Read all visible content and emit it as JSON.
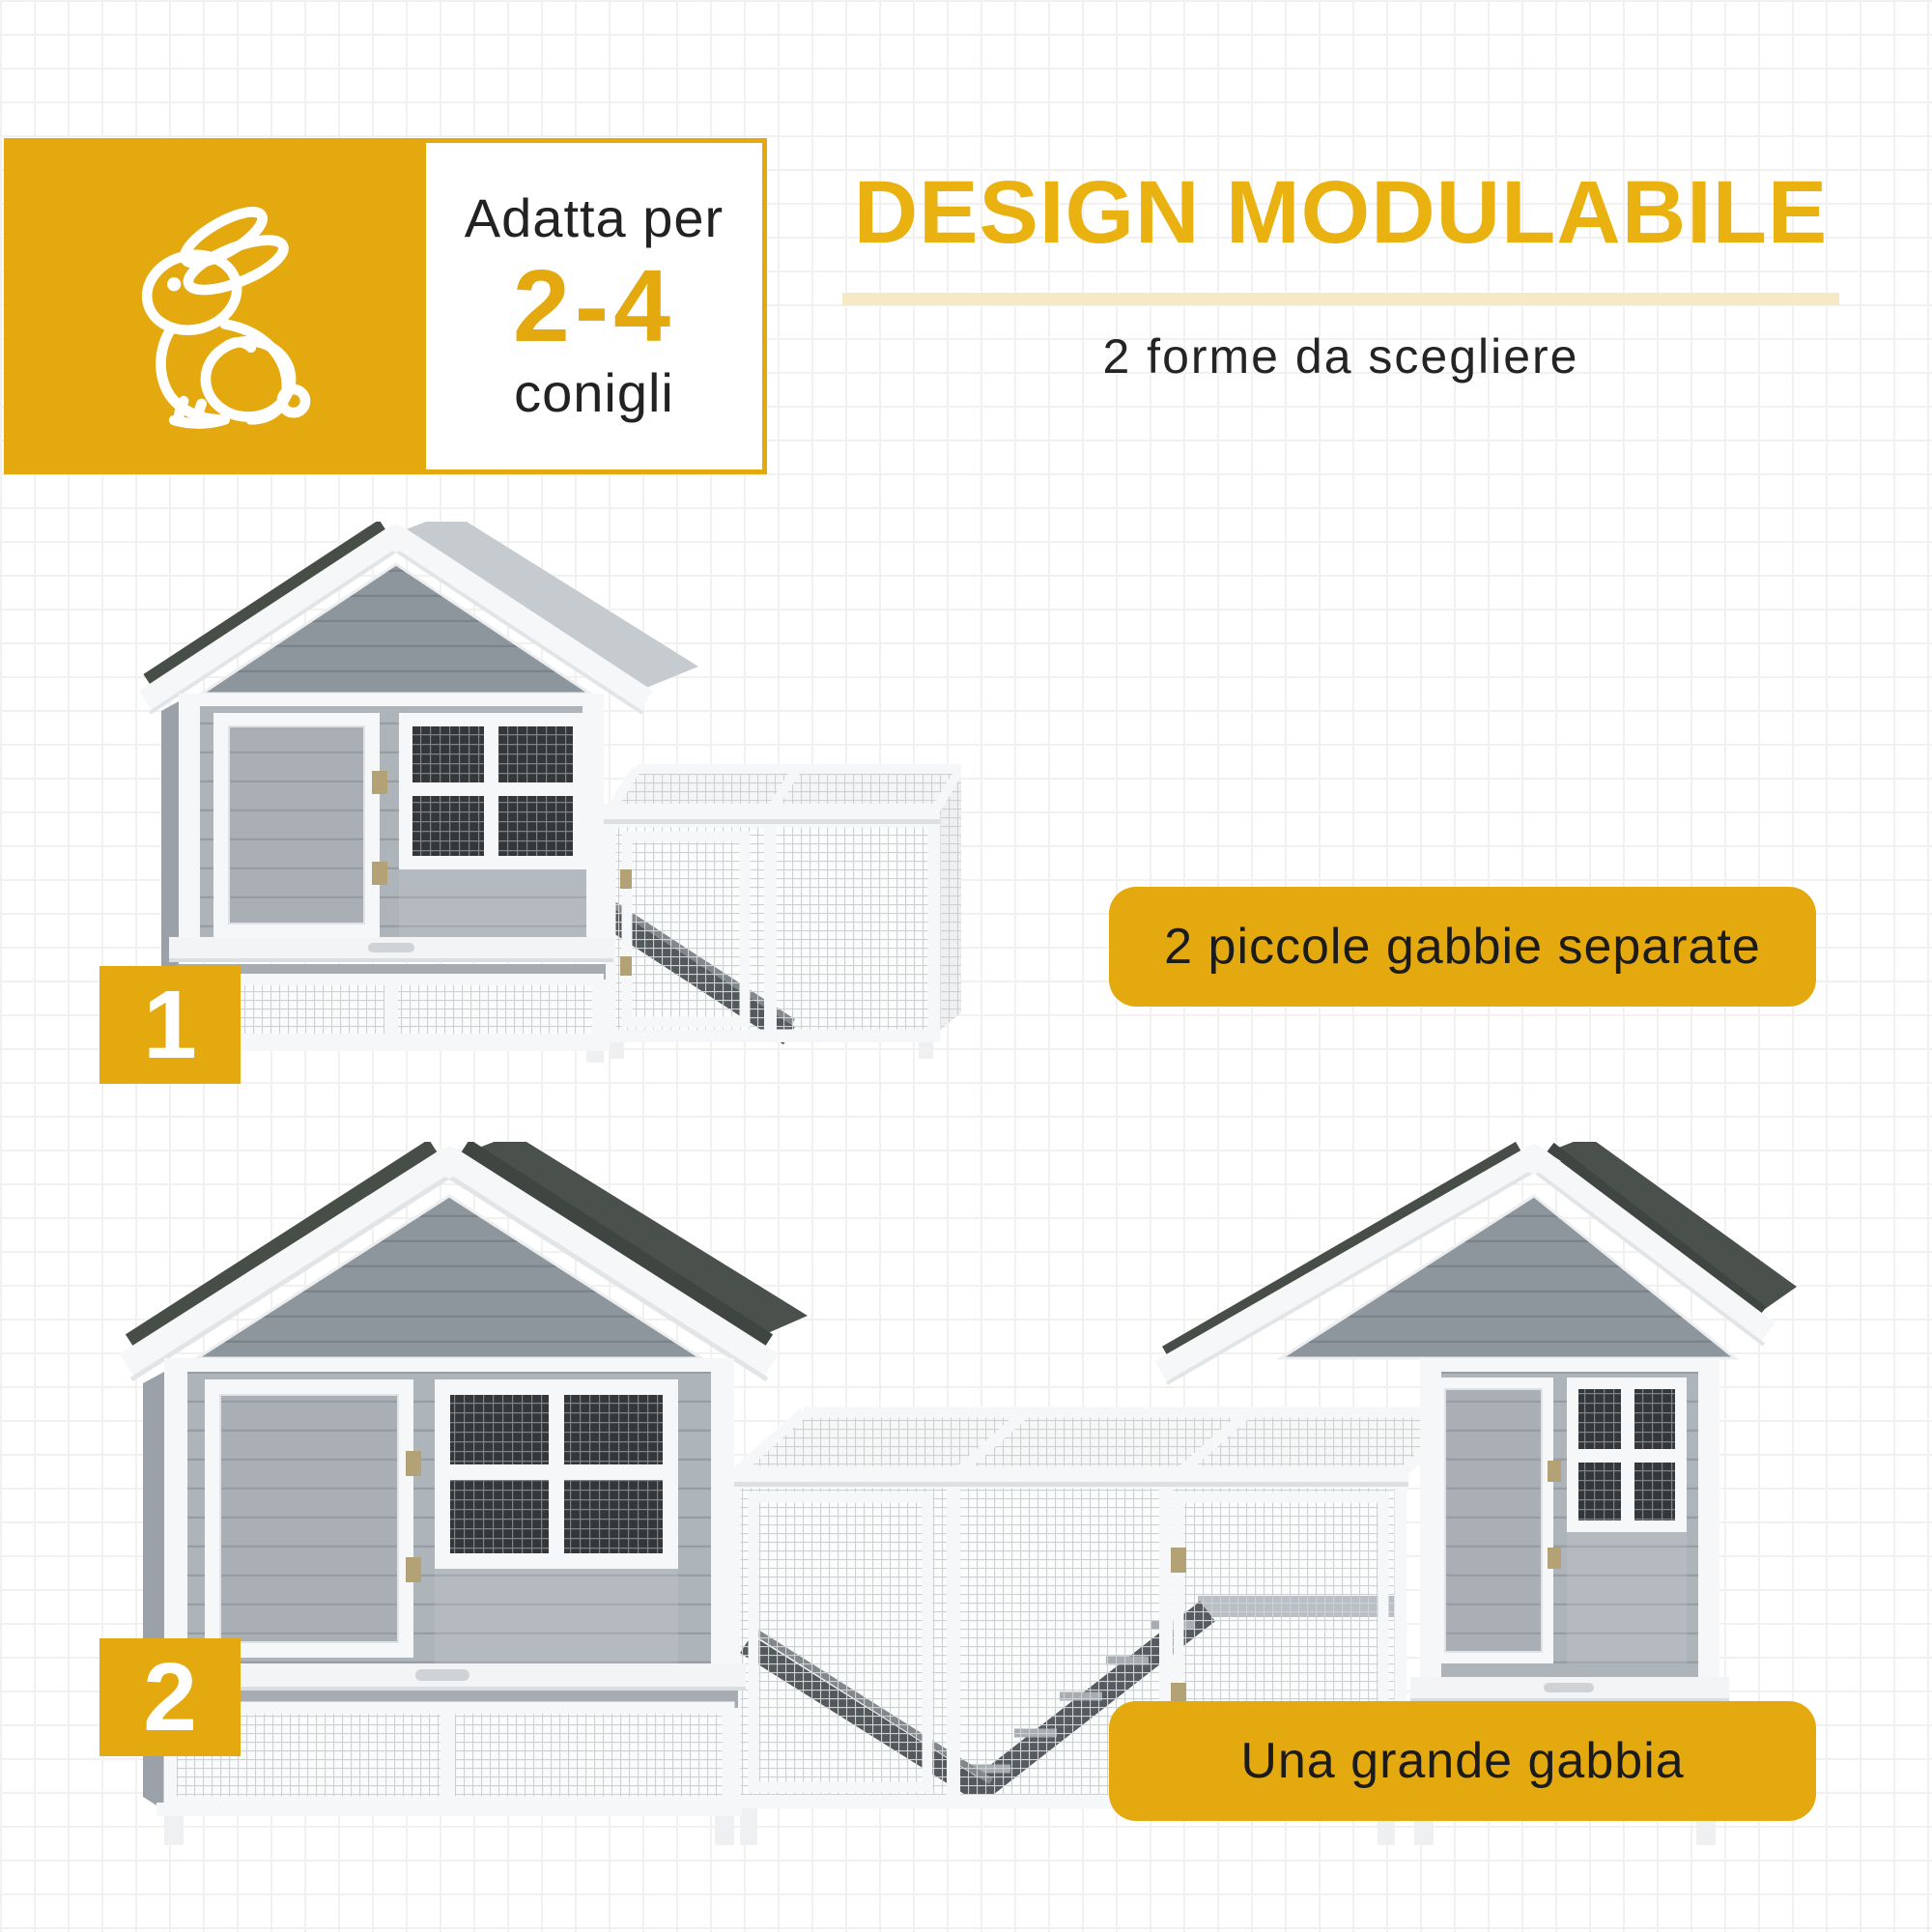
{
  "colors": {
    "accent": "#E3A90F",
    "accent_pale": "#F6E9C5",
    "heading_yellow": "#EAB211",
    "text_dark": "#1F1F1F",
    "roof_dark": "#474D47",
    "wood_gray": "#8E969D",
    "frame_white": "#F5F7F8"
  },
  "capacity_card": {
    "icon": "rabbit-icon",
    "prefix": "Adatta per",
    "range": "2-4",
    "suffix": "conigli"
  },
  "header": {
    "title": "DESIGN MODULABILE",
    "subtitle": "2 forme da scegliere"
  },
  "options": [
    {
      "number": "1",
      "caption": "2 piccole gabbie separate",
      "image": "hutch-two-small-cages"
    },
    {
      "number": "2",
      "caption": "Una grande gabbia",
      "image": "hutch-one-big-cage"
    }
  ]
}
